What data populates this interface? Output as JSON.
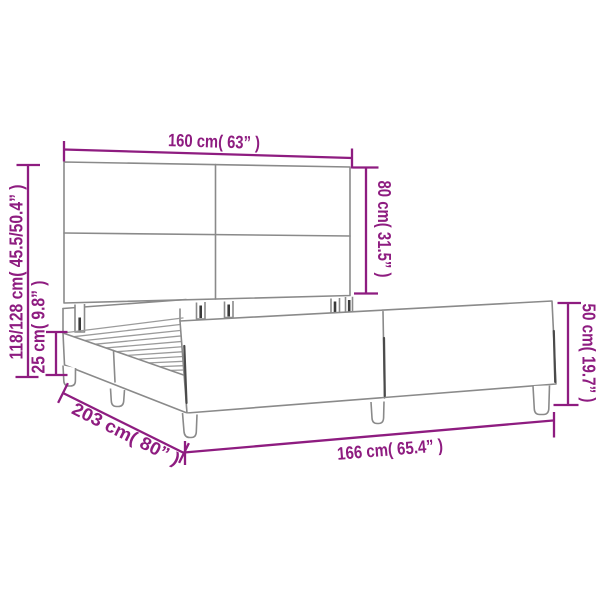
{
  "diagram": {
    "kind": "product-dimension-diagram",
    "product": "bed-frame-with-headboard",
    "dimensions": {
      "headboard_width": {
        "label": "160 cm( 63” )",
        "cm": "160",
        "inch": "63"
      },
      "headboard_height": {
        "label": "80 cm( 31.5” )",
        "cm": "80",
        "inch": "31.5"
      },
      "overall_height": {
        "label": "118/128 cm( 45.5/50.4” )",
        "cm": "118/128",
        "inch": "45.5/50.4"
      },
      "base_height": {
        "label": "25 cm( 9.8” )",
        "cm": "25",
        "inch": "9.8"
      },
      "frame_length": {
        "label": "203 cm( 80” )",
        "cm": "203",
        "inch": "80"
      },
      "frame_width": {
        "label": "166 cm( 65.4” )",
        "cm": "166",
        "inch": "65.4"
      },
      "footend_height": {
        "label": "50 cm( 19.7” )",
        "cm": "50",
        "inch": "19.7"
      }
    },
    "colors": {
      "dimension": "#8E1C80",
      "outline": "#8A8A8A",
      "background": "#FFFFFF"
    }
  }
}
